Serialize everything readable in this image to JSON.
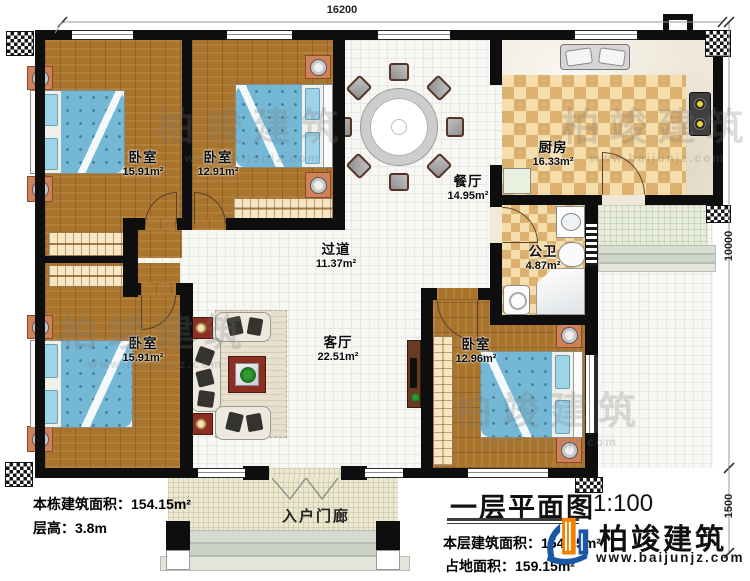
{
  "plan": {
    "dim_top": "16200",
    "dim_right": "10000",
    "dim_porch": "1500",
    "rooms": {
      "bedroom_tl": {
        "name": "卧室",
        "area": "15.91m²"
      },
      "bedroom_tm": {
        "name": "卧室",
        "area": "12.91m²"
      },
      "dining": {
        "name": "餐厅",
        "area": "14.95m²"
      },
      "kitchen": {
        "name": "厨房",
        "area": "16.33m²"
      },
      "bathroom": {
        "name": "公卫",
        "area": "4.87m²"
      },
      "hallway": {
        "name": "过道",
        "area": "11.37m²"
      },
      "living": {
        "name": "客厅",
        "area": "22.51m²"
      },
      "bedroom_bl": {
        "name": "卧室",
        "area": "15.91m²"
      },
      "bedroom_br": {
        "name": "卧室",
        "area": "12.96m²"
      },
      "porch": {
        "name": "入户门廊"
      }
    },
    "info_left": {
      "line1": "本栋建筑面积：154.15m²",
      "line2": "层高：3.8m"
    },
    "title_block": {
      "title": "一层平面图",
      "scale": "1:100",
      "line1": "本层建筑面积：154.15m²",
      "line2": "占地面积：159.15m²"
    },
    "brand": {
      "name": "柏竣建筑",
      "url": "www.baijunjz.com"
    },
    "watermark": {
      "text": "柏竣建筑",
      "url": "www.baijunjz.com"
    },
    "colors": {
      "accent_blue": "#1a57a5",
      "accent_orange": "#f08300",
      "wall": "#0e0e0e"
    }
  }
}
